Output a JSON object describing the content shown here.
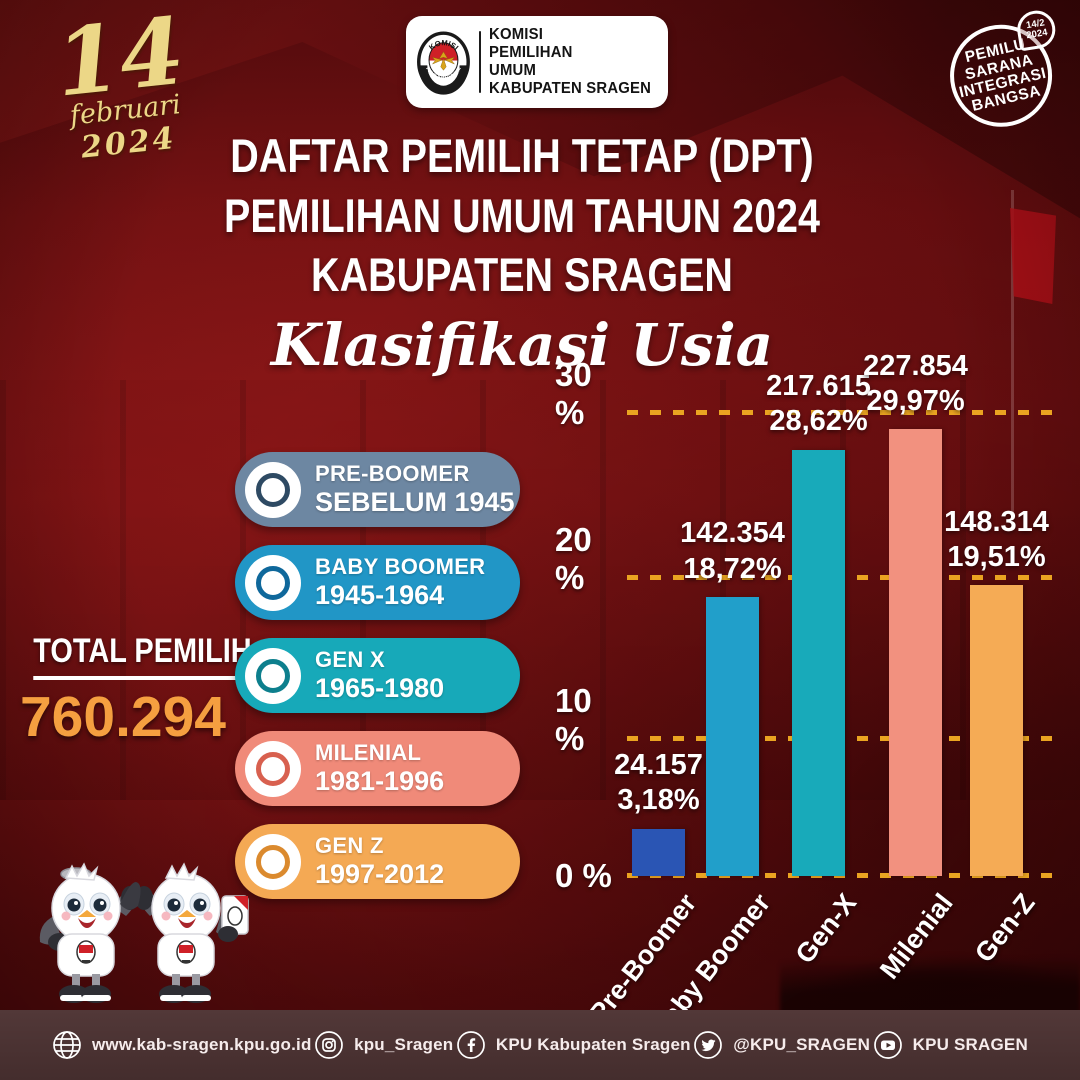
{
  "date_badge": {
    "day": "14",
    "month": "februari",
    "year": "2024"
  },
  "logo_card": {
    "seal_top": "KOMISI",
    "seal_bottom": "PEMILIHAN UMUM",
    "org_line1": "KOMISI",
    "org_line2": "PEMILIHAN",
    "org_line3": "UMUM",
    "org_line4": "KABUPATEN SRAGEN"
  },
  "round_badge": {
    "line1": "PEMILU",
    "line2": "SARANA",
    "line3": "INTEGRASI",
    "line4": "BANGSA",
    "bubble_line1": "14/2",
    "bubble_line2": "2024"
  },
  "title": {
    "line1": "DAFTAR PEMILIH TETAP (DPT)",
    "line2": "PEMILIHAN UMUM TAHUN 2024",
    "line3": "KABUPATEN SRAGEN",
    "subtitle": "Klasifikasi Usia"
  },
  "total": {
    "label": "TOTAL PEMILIH",
    "value": "760.294",
    "value_color": "#f59f40"
  },
  "legend": {
    "items": [
      {
        "label": "PRE-BOOMER",
        "range": "SEBELUM 1945",
        "color": "#6d87a2",
        "ring": "#2e4a63"
      },
      {
        "label": "BABY BOOMER",
        "range": "1945-1964",
        "color": "#2196c6",
        "ring": "#0f689b"
      },
      {
        "label": "GEN X",
        "range": "1965-1980",
        "color": "#17a9b9",
        "ring": "#0d7f8d"
      },
      {
        "label": "MILENIAL",
        "range": "1981-1996",
        "color": "#f08a79",
        "ring": "#d8604f"
      },
      {
        "label": "GEN Z",
        "range": "1997-2012",
        "color": "#f4a954",
        "ring": "#db8a2e"
      }
    ]
  },
  "chart_data": {
    "type": "bar",
    "title": "DPT Pemilihan Umum Tahun 2024 Kabupaten Sragen - Klasifikasi Usia",
    "categories": [
      "Pre-Boomer",
      "Baby Boomer",
      "Gen-X",
      "Milenial",
      "Gen-Z"
    ],
    "values": [
      24157,
      142354,
      217615,
      227854,
      148314
    ],
    "percentages": [
      3.18,
      18.72,
      28.62,
      29.97,
      19.51
    ],
    "value_labels": [
      "24.157",
      "142.354",
      "217.615",
      "227.854",
      "148.314"
    ],
    "pct_labels": [
      "3,18%",
      "18,72%",
      "28,62%",
      "29,97%",
      "19,51%"
    ],
    "bar_colors": [
      "#2a55b4",
      "#219fca",
      "#18aaba",
      "#f2917f",
      "#f5ab55"
    ],
    "ytick_labels": [
      "0 %",
      "10 %",
      "20 %",
      "30 %"
    ],
    "ylim": [
      0,
      30
    ],
    "grid": "horizontal dashed",
    "gridline_color": "#eaa421",
    "legend_position": "left",
    "total_voters": 760294
  },
  "footer": {
    "items": [
      {
        "icon": "globe-icon",
        "label": "www.kab-sragen.kpu.go.id"
      },
      {
        "icon": "instagram-icon",
        "label": "kpu_Sragen"
      },
      {
        "icon": "facebook-icon",
        "label": "KPU Kabupaten Sragen"
      },
      {
        "icon": "twitter-icon",
        "label": "@KPU_SRAGEN"
      },
      {
        "icon": "youtube-icon",
        "label": "KPU SRAGEN"
      }
    ]
  }
}
